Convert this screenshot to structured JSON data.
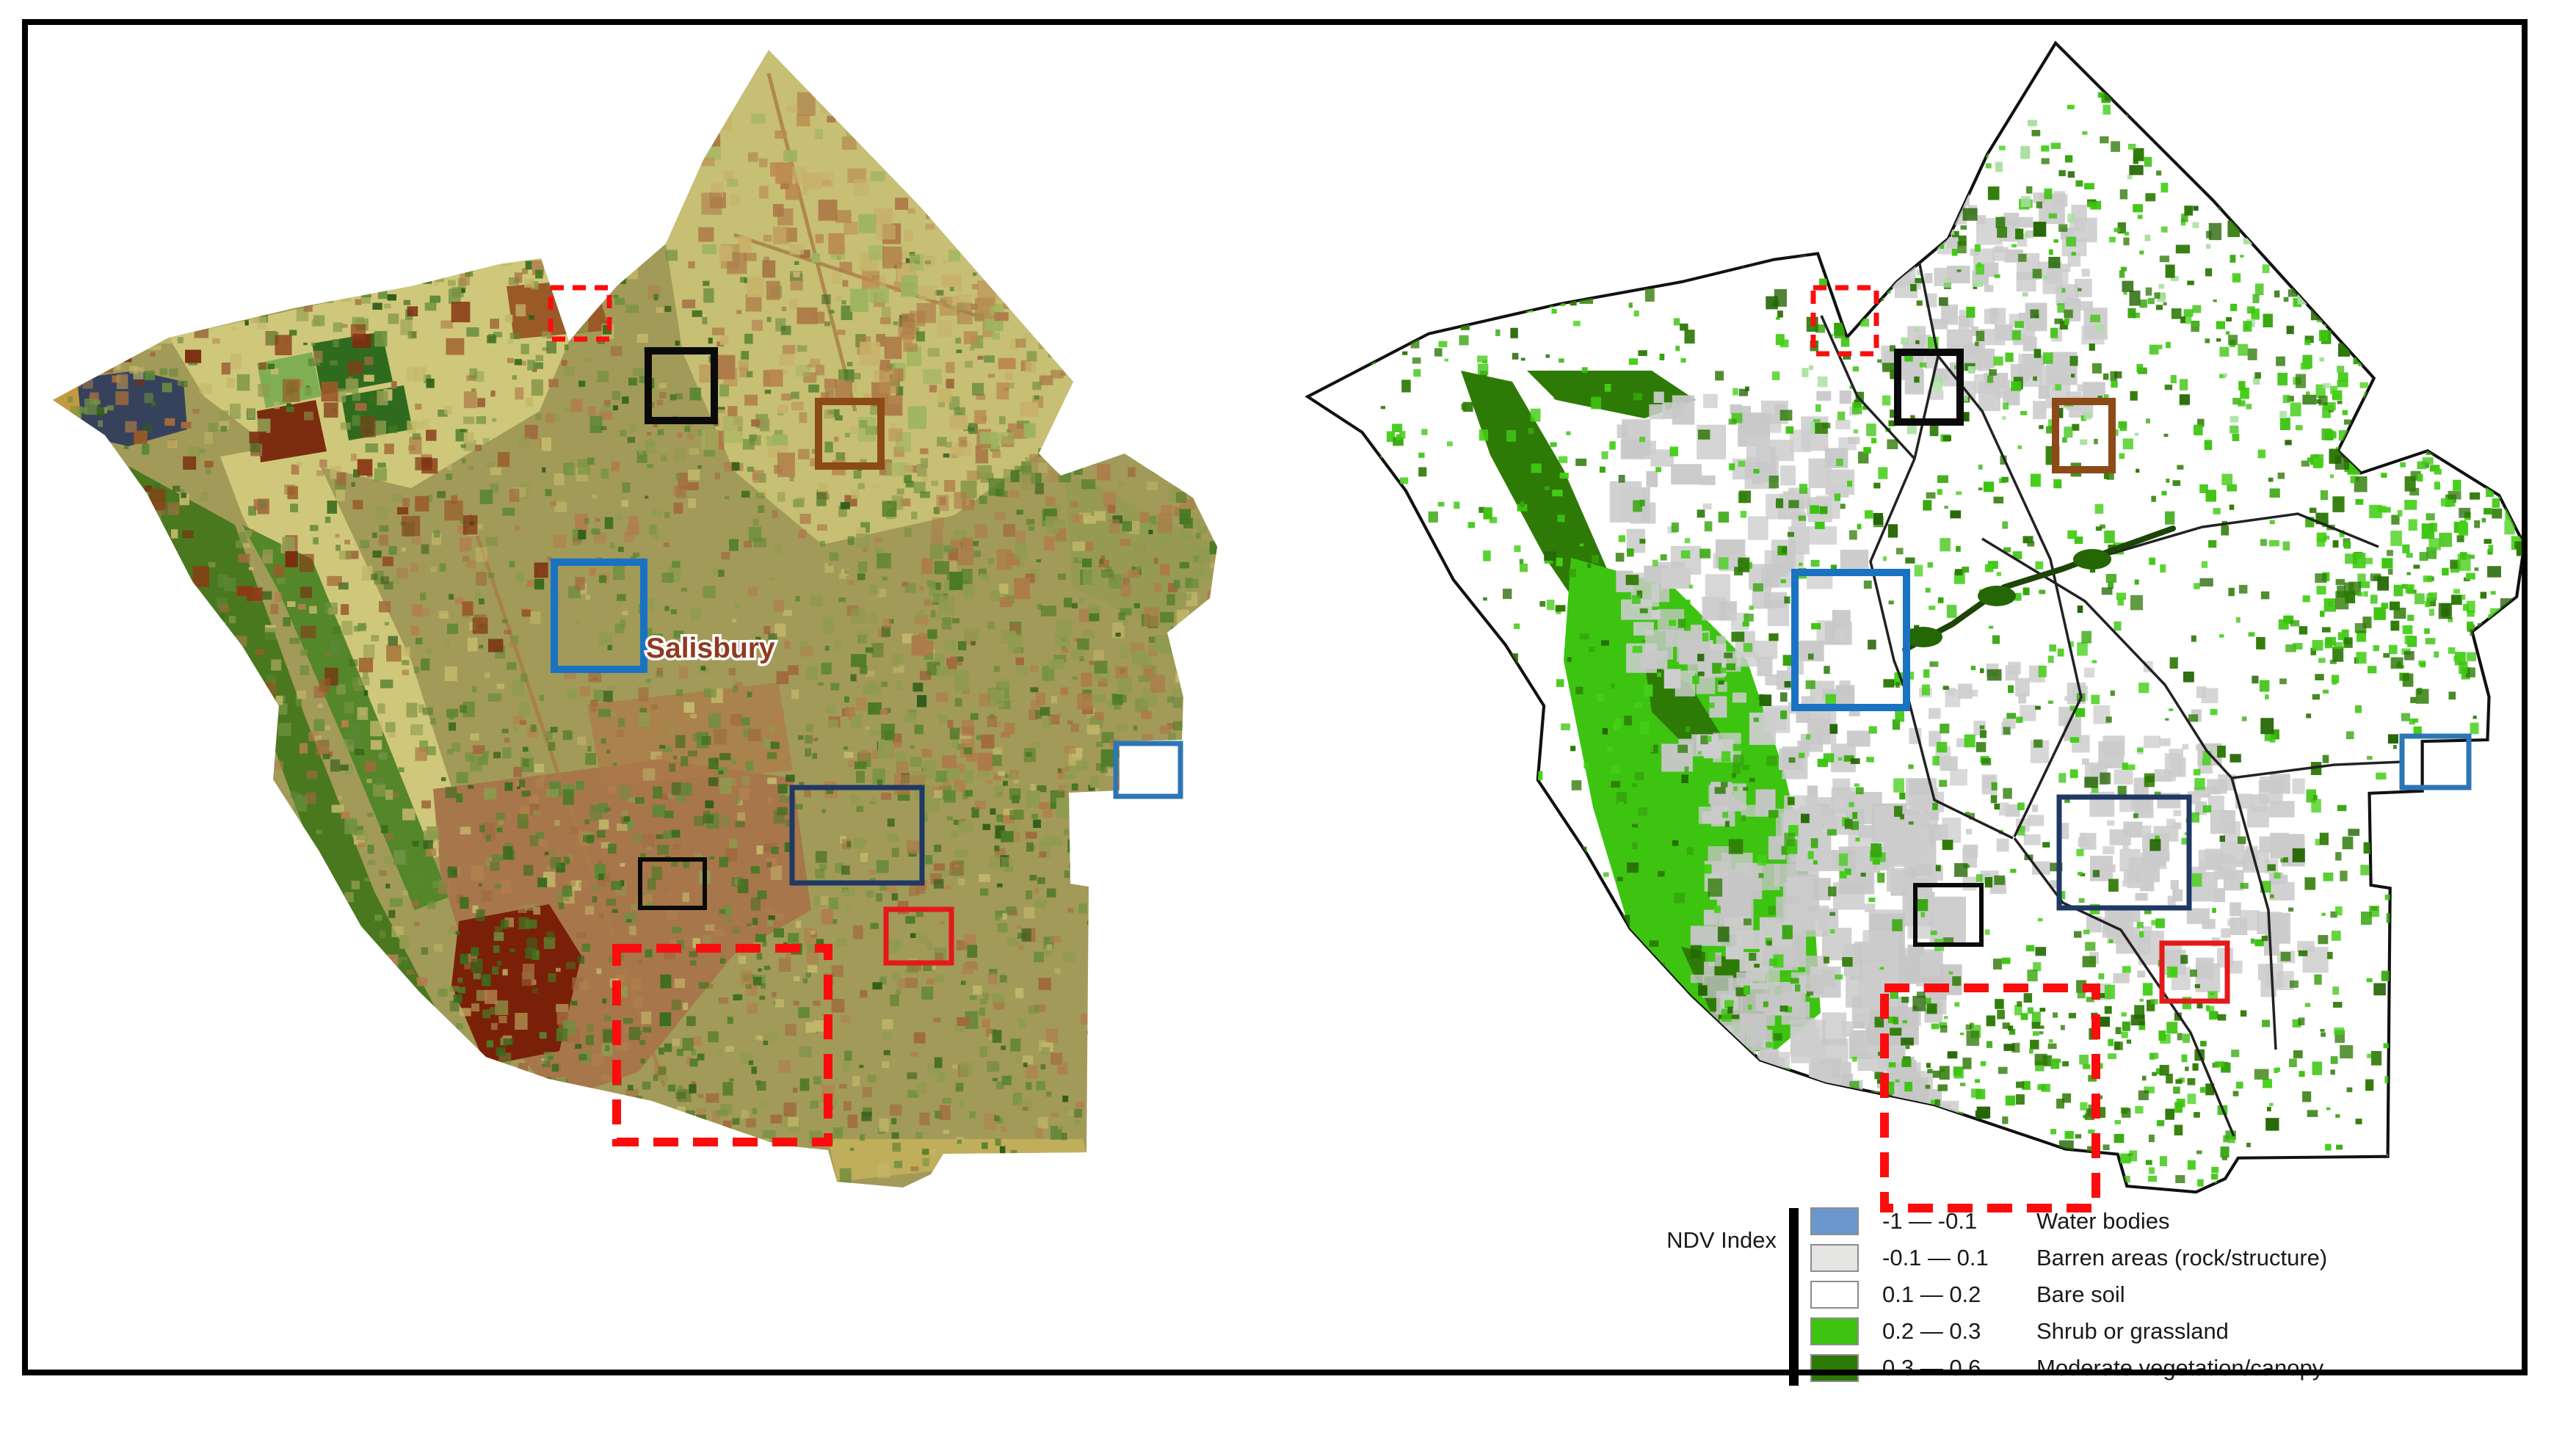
{
  "maps": {
    "left": {
      "name": "ndvi-raster-map",
      "place_label": "Salisbury"
    },
    "right": {
      "name": "ndvi-classified-map"
    }
  },
  "legend": {
    "title": "NDV Index",
    "classes": [
      {
        "range": "-1 — -0.1",
        "label": "Water bodies",
        "color": "#6a98ce"
      },
      {
        "range": "-0.1 — 0.1",
        "label": "Barren areas (rock/structure)",
        "color": "#e4e4e2"
      },
      {
        "range": "0.1 — 0.2",
        "label": "Bare soil",
        "color": "#ffffff"
      },
      {
        "range": "0.2 — 0.3",
        "label": "Shrub or grassland",
        "color": "#3cc410"
      },
      {
        "range": "0.3 — 0.6",
        "label": "Moderate vegetation/canopy",
        "color": "#2e7a06"
      }
    ]
  },
  "annotation_boxes": [
    {
      "id": "site-red-dashed-small",
      "color": "#fb0d0d",
      "style": "dashed",
      "stroke": 7,
      "dash": "18 12",
      "left": [
        750,
        392,
        80,
        70
      ],
      "right": [
        2470,
        392,
        86,
        90
      ]
    },
    {
      "id": "site-black-north",
      "color": "#0a0a0a",
      "style": "solid",
      "stroke": 10,
      "left": [
        883,
        478,
        90,
        95
      ],
      "right": [
        2585,
        480,
        85,
        95
      ]
    },
    {
      "id": "site-brown",
      "color": "#8c4a17",
      "style": "solid",
      "stroke": 10,
      "left": [
        1115,
        547,
        85,
        88
      ],
      "right": [
        2800,
        547,
        77,
        93
      ]
    },
    {
      "id": "site-blue-city",
      "color": "#1a73c2",
      "style": "solid",
      "stroke": 10,
      "left": [
        755,
        766,
        122,
        146
      ],
      "right": [
        2445,
        780,
        152,
        184
      ]
    },
    {
      "id": "site-navy",
      "color": "#1f3864",
      "style": "solid",
      "stroke": 7,
      "left": [
        1079,
        1073,
        177,
        130
      ],
      "right": [
        2805,
        1086,
        177,
        151
      ]
    },
    {
      "id": "site-black-south",
      "color": "#0a0a0a",
      "style": "solid",
      "stroke": 6,
      "left": [
        872,
        1171,
        88,
        66
      ],
      "right": [
        2609,
        1206,
        90,
        81
      ]
    },
    {
      "id": "site-red-solid",
      "color": "#e31a1a",
      "style": "solid",
      "stroke": 7,
      "left": [
        1207,
        1239,
        89,
        73
      ],
      "right": [
        2945,
        1285,
        89,
        79
      ]
    },
    {
      "id": "site-red-dashed-large",
      "color": "#fb0d0d",
      "style": "dashed",
      "stroke": 12,
      "dash": "34 20",
      "left": [
        840,
        1292,
        288,
        264
      ],
      "right": [
        2567,
        1346,
        288,
        300
      ]
    },
    {
      "id": "site-blue-small",
      "color": "#2e75b6",
      "style": "solid",
      "stroke": 7,
      "left": [
        1520,
        1013,
        88,
        72
      ],
      "right": [
        3272,
        1003,
        91,
        70
      ]
    }
  ]
}
